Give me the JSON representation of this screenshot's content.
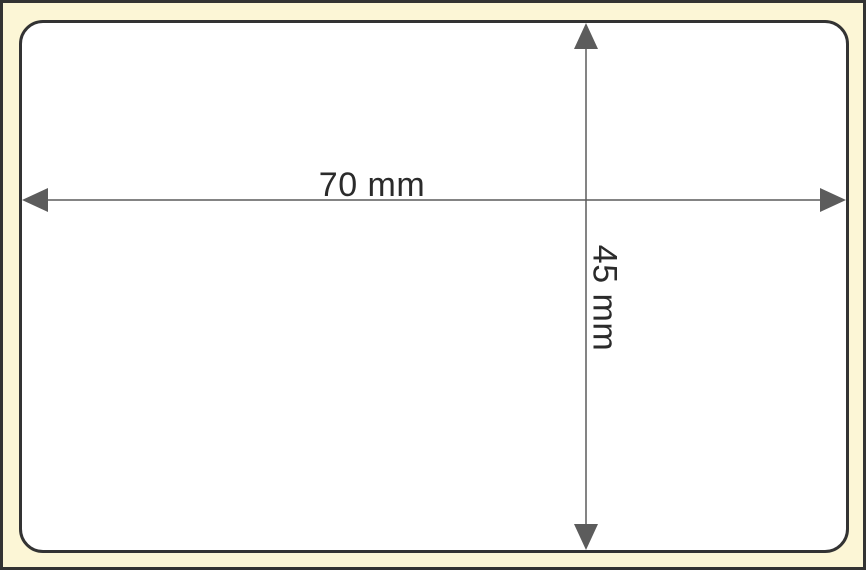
{
  "diagram": {
    "title": "label-size-diagram",
    "width_dimension": {
      "label": "70 mm"
    },
    "height_dimension": {
      "label": "45 mm"
    },
    "colors": {
      "canvas_background": "#fcf6d6",
      "label_fill": "#ffffff",
      "outline": "#333333",
      "dimension_line": "#5c5c5c",
      "dimension_text": "#2b2b2b"
    }
  }
}
